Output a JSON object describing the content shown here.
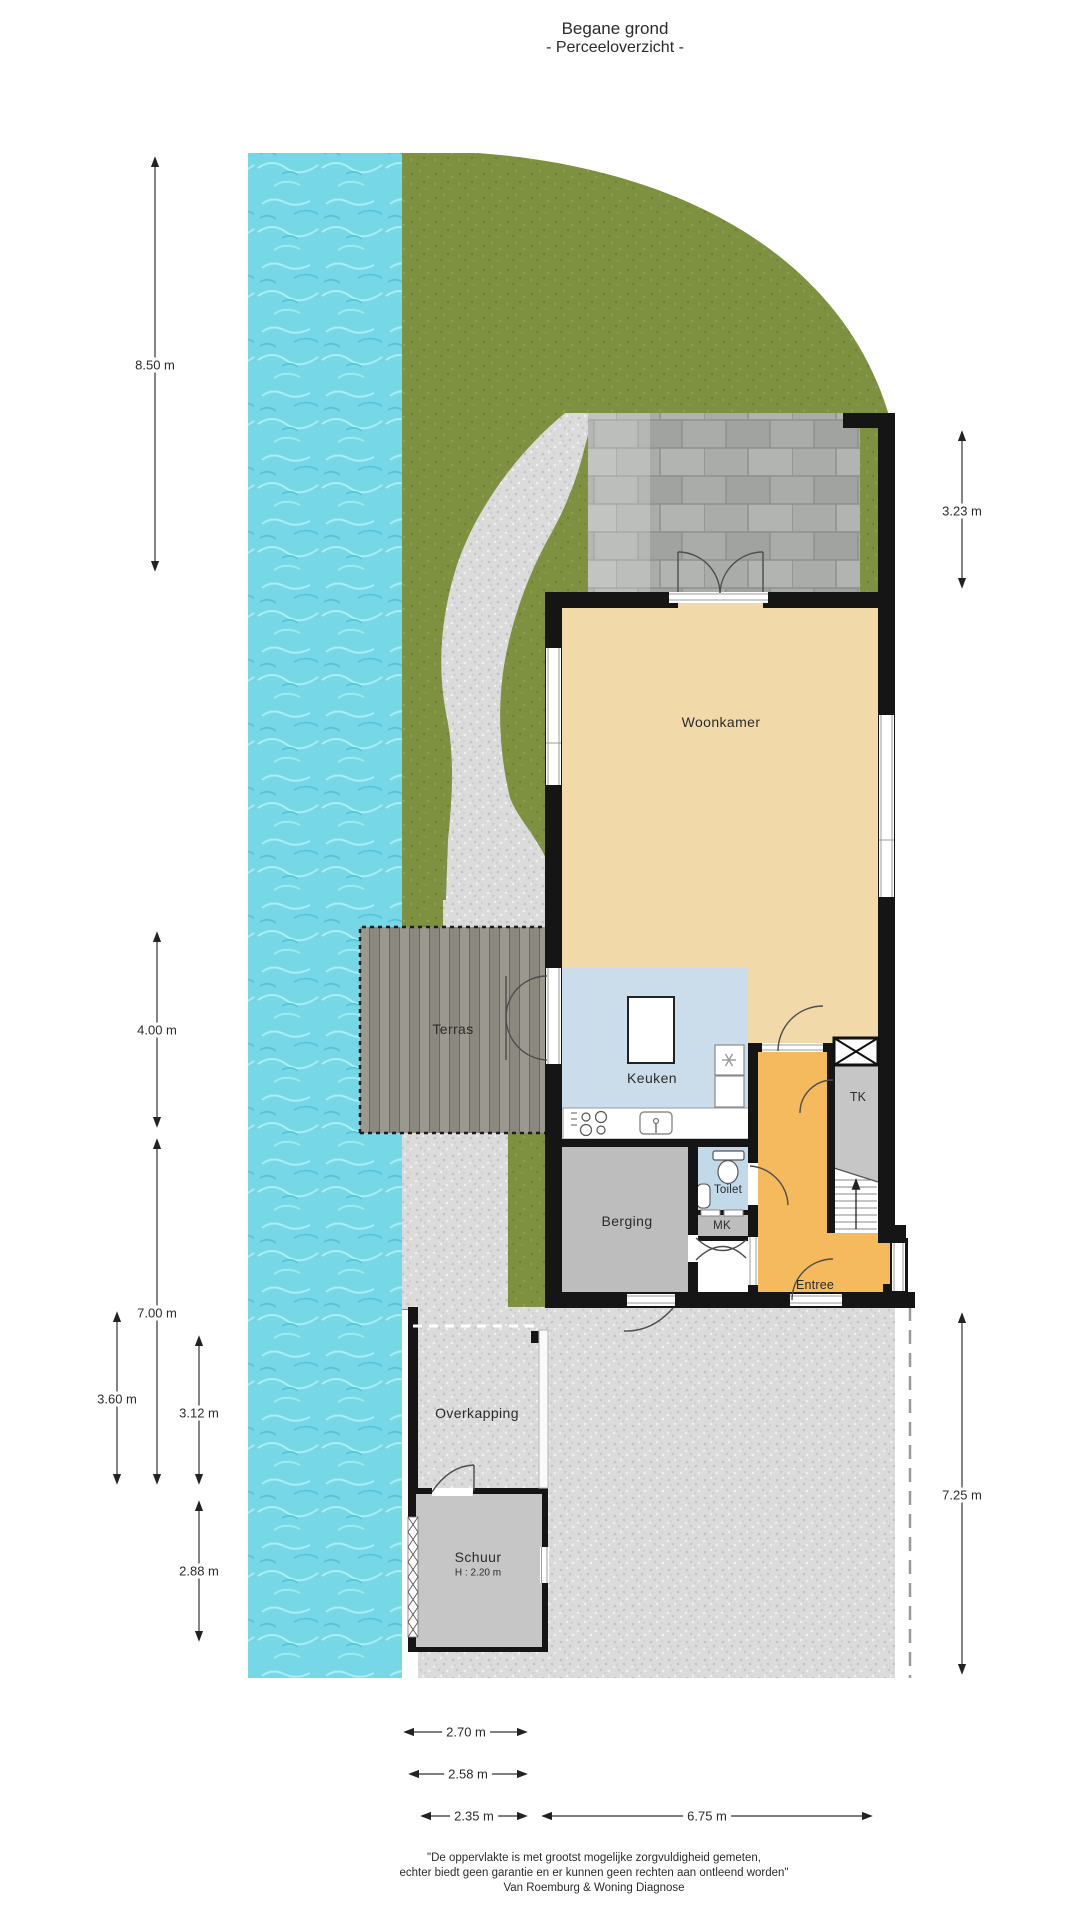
{
  "title": {
    "line1": "Begane grond",
    "line2": "- Perceeloverzicht -"
  },
  "rooms": {
    "woonkamer": "Woonkamer",
    "keuken": "Keuken",
    "terras": "Terras",
    "berging": "Berging",
    "toilet": "Toilet",
    "mk": "MK",
    "tk": "TK",
    "entree": "Entree",
    "overkapping": "Overkapping",
    "schuur": "Schuur",
    "schuur_height": "H : 2.20 m"
  },
  "dimensions": {
    "d850": "8.50 m",
    "d323": "3.23 m",
    "d400": "4.00 m",
    "d700": "7.00 m",
    "d360": "3.60 m",
    "d312": "3.12 m",
    "d288": "2.88 m",
    "d725": "7.25 m",
    "d270": "2.70 m",
    "d258": "2.58 m",
    "d235": "2.35 m",
    "d675": "6.75 m"
  },
  "footer": {
    "line1": "\"De oppervlakte is met grootst mogelijke zorgvuldigheid gemeten,",
    "line2": "echter biedt geen garantie en er kunnen geen rechten aan ontleend worden\"",
    "line3": "Van Roemburg & Woning Diagnose"
  },
  "colors": {
    "water": "#76d7e6",
    "grass": "#7d9141",
    "gravel": "#dbdbdb",
    "pavers": "#a9aca9",
    "deck": "#95928a",
    "wall": "#151515",
    "woonkamer_floor": "#f2d9a9",
    "keuken_floor": "#cbdcea",
    "toilet_floor": "#c2d9ea",
    "entree_floor": "#f6ba5e",
    "storage_floor": "#bdbdbd",
    "schuur_floor": "#c6c6c6"
  },
  "icons": [
    "stove-icon",
    "kitchen-sink-icon",
    "kitchen-island-icon",
    "appliance-asterisk-icon",
    "toilet-icon",
    "washbasin-icon",
    "stairs-up-icon",
    "ventilation-shaft-icon"
  ]
}
